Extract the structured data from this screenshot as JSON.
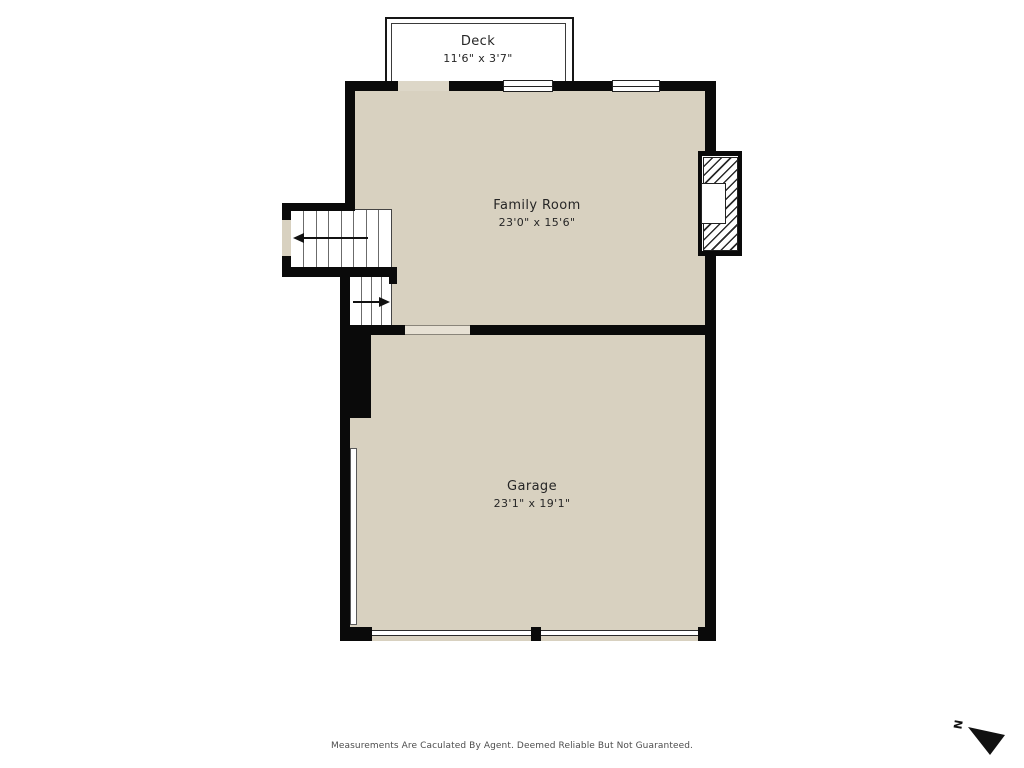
{
  "rooms": {
    "deck": {
      "name": "Deck",
      "dims": "11'6\" x 3'7\""
    },
    "family_room": {
      "name": "Family Room",
      "dims": "23'0\" x 15'6\""
    },
    "garage": {
      "name": "Garage",
      "dims": "23'1\" x 19'1\""
    }
  },
  "compass": {
    "label": "N"
  },
  "footer": {
    "disclaimer": "Measurements Are Caculated By Agent. Deemed Reliable But Not Guaranteed."
  },
  "colors": {
    "floor": "#d8d1c0",
    "wall": "#0a0a0a",
    "opening": "#e7e1d4",
    "deck_gap": "#ddd7c8",
    "text": "#262626",
    "footer_text": "#4d4d4d"
  }
}
